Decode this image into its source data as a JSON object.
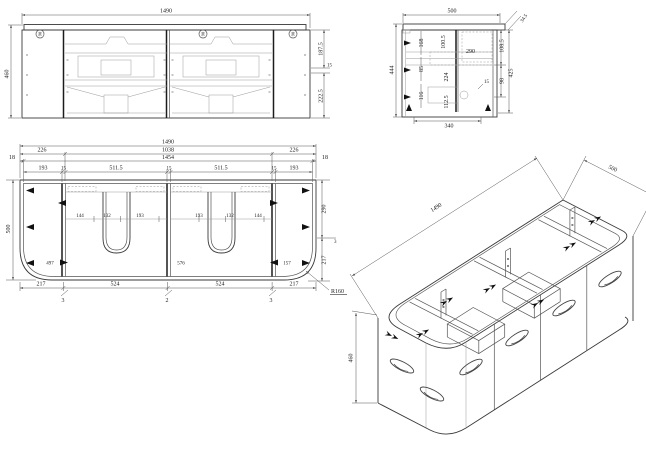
{
  "drawing": {
    "front": {
      "width": "1490",
      "height": "460",
      "right_chain": [
        "187.5",
        "15",
        "222.5"
      ],
      "hinges": [
        "90",
        "90",
        "90"
      ]
    },
    "side": {
      "width": "500",
      "height": "444",
      "corner": "34.5",
      "left_chain": [
        "168",
        "85",
        "116"
      ],
      "mid_chain": [
        "100.5",
        "224",
        "112.5"
      ],
      "center": "290",
      "right_chain": [
        "108.5",
        "98"
      ],
      "right_total": "425",
      "leader": "15",
      "bottom": "340"
    },
    "plan": {
      "row1": "1490",
      "row2": [
        "226",
        "1038",
        "226"
      ],
      "row3": [
        "18",
        "1454",
        "18"
      ],
      "row4": [
        "193",
        "15",
        "511.5",
        "15",
        "511.5",
        "15",
        "193"
      ],
      "left": "500",
      "right_chain": [
        "290",
        "3",
        "217"
      ],
      "radius": "R160",
      "inner": [
        "144",
        "132",
        "193",
        "193",
        "132",
        "144"
      ],
      "mid": [
        "497",
        "576",
        "157"
      ],
      "bottom": [
        "217",
        "524",
        "524",
        "217"
      ],
      "callouts": [
        "3",
        "2",
        "3"
      ]
    },
    "iso": {
      "length": "1490",
      "depth": "500",
      "height": "460"
    }
  }
}
